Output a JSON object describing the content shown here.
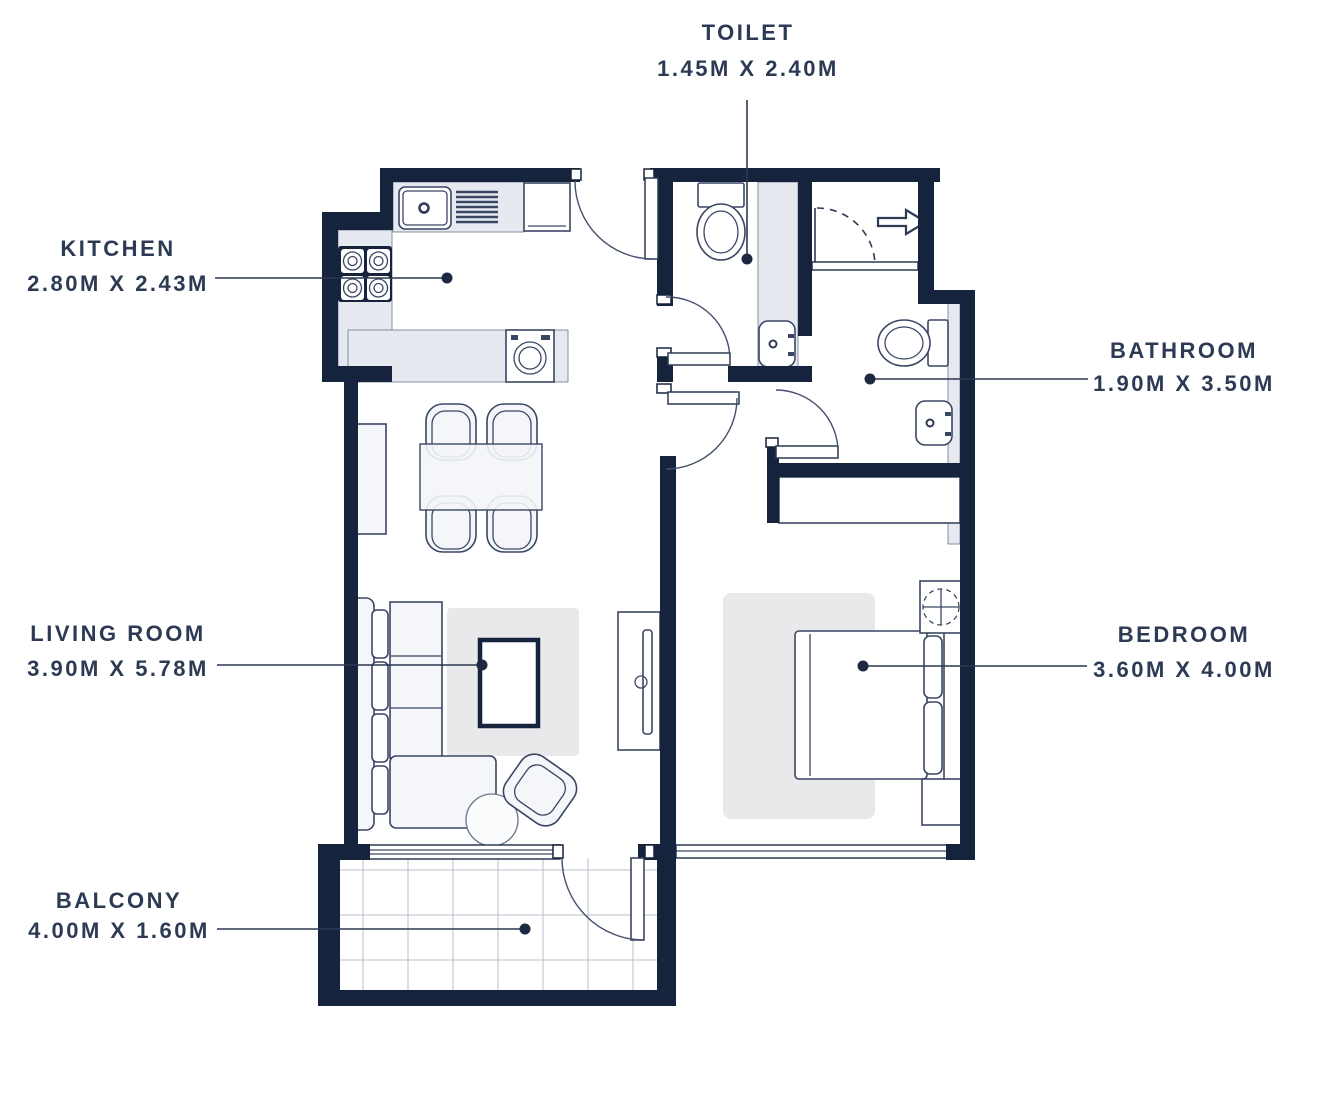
{
  "colors": {
    "wall": "#16233c",
    "label_text": "#2d3a54",
    "counter_gray": "#e6eaf0",
    "rug_gray": "#e9e9ec",
    "fixture_stroke": "#3a4763",
    "background": "#ffffff"
  },
  "rooms": [
    {
      "id": "toilet",
      "name": "TOILET",
      "dimensions": "1.45M X 2.40M"
    },
    {
      "id": "kitchen",
      "name": "KITCHEN",
      "dimensions": "2.80M X 2.43M"
    },
    {
      "id": "bathroom",
      "name": "BATHROOM",
      "dimensions": "1.90M X 3.50M"
    },
    {
      "id": "living_room",
      "name": "LIVING ROOM",
      "dimensions": "3.90M X 5.78M"
    },
    {
      "id": "bedroom",
      "name": "BEDROOM",
      "dimensions": "3.60M X 4.00M"
    },
    {
      "id": "balcony",
      "name": "BALCONY",
      "dimensions": "4.00M X 1.60M"
    }
  ],
  "fixtures": [
    "kitchen-sink",
    "drainboard",
    "fridge",
    "stove",
    "washing-machine",
    "dining-table",
    "dining-chair",
    "sofa",
    "chaise",
    "coffee-table",
    "armchair",
    "side-table",
    "tv-unit",
    "sideboard",
    "bed",
    "pillow",
    "nightstand",
    "table-fan",
    "wardrobe",
    "toilet",
    "wash-basin",
    "vanity-counter",
    "entry-arrow",
    "entry-door",
    "sliding-window",
    "balcony-door"
  ]
}
